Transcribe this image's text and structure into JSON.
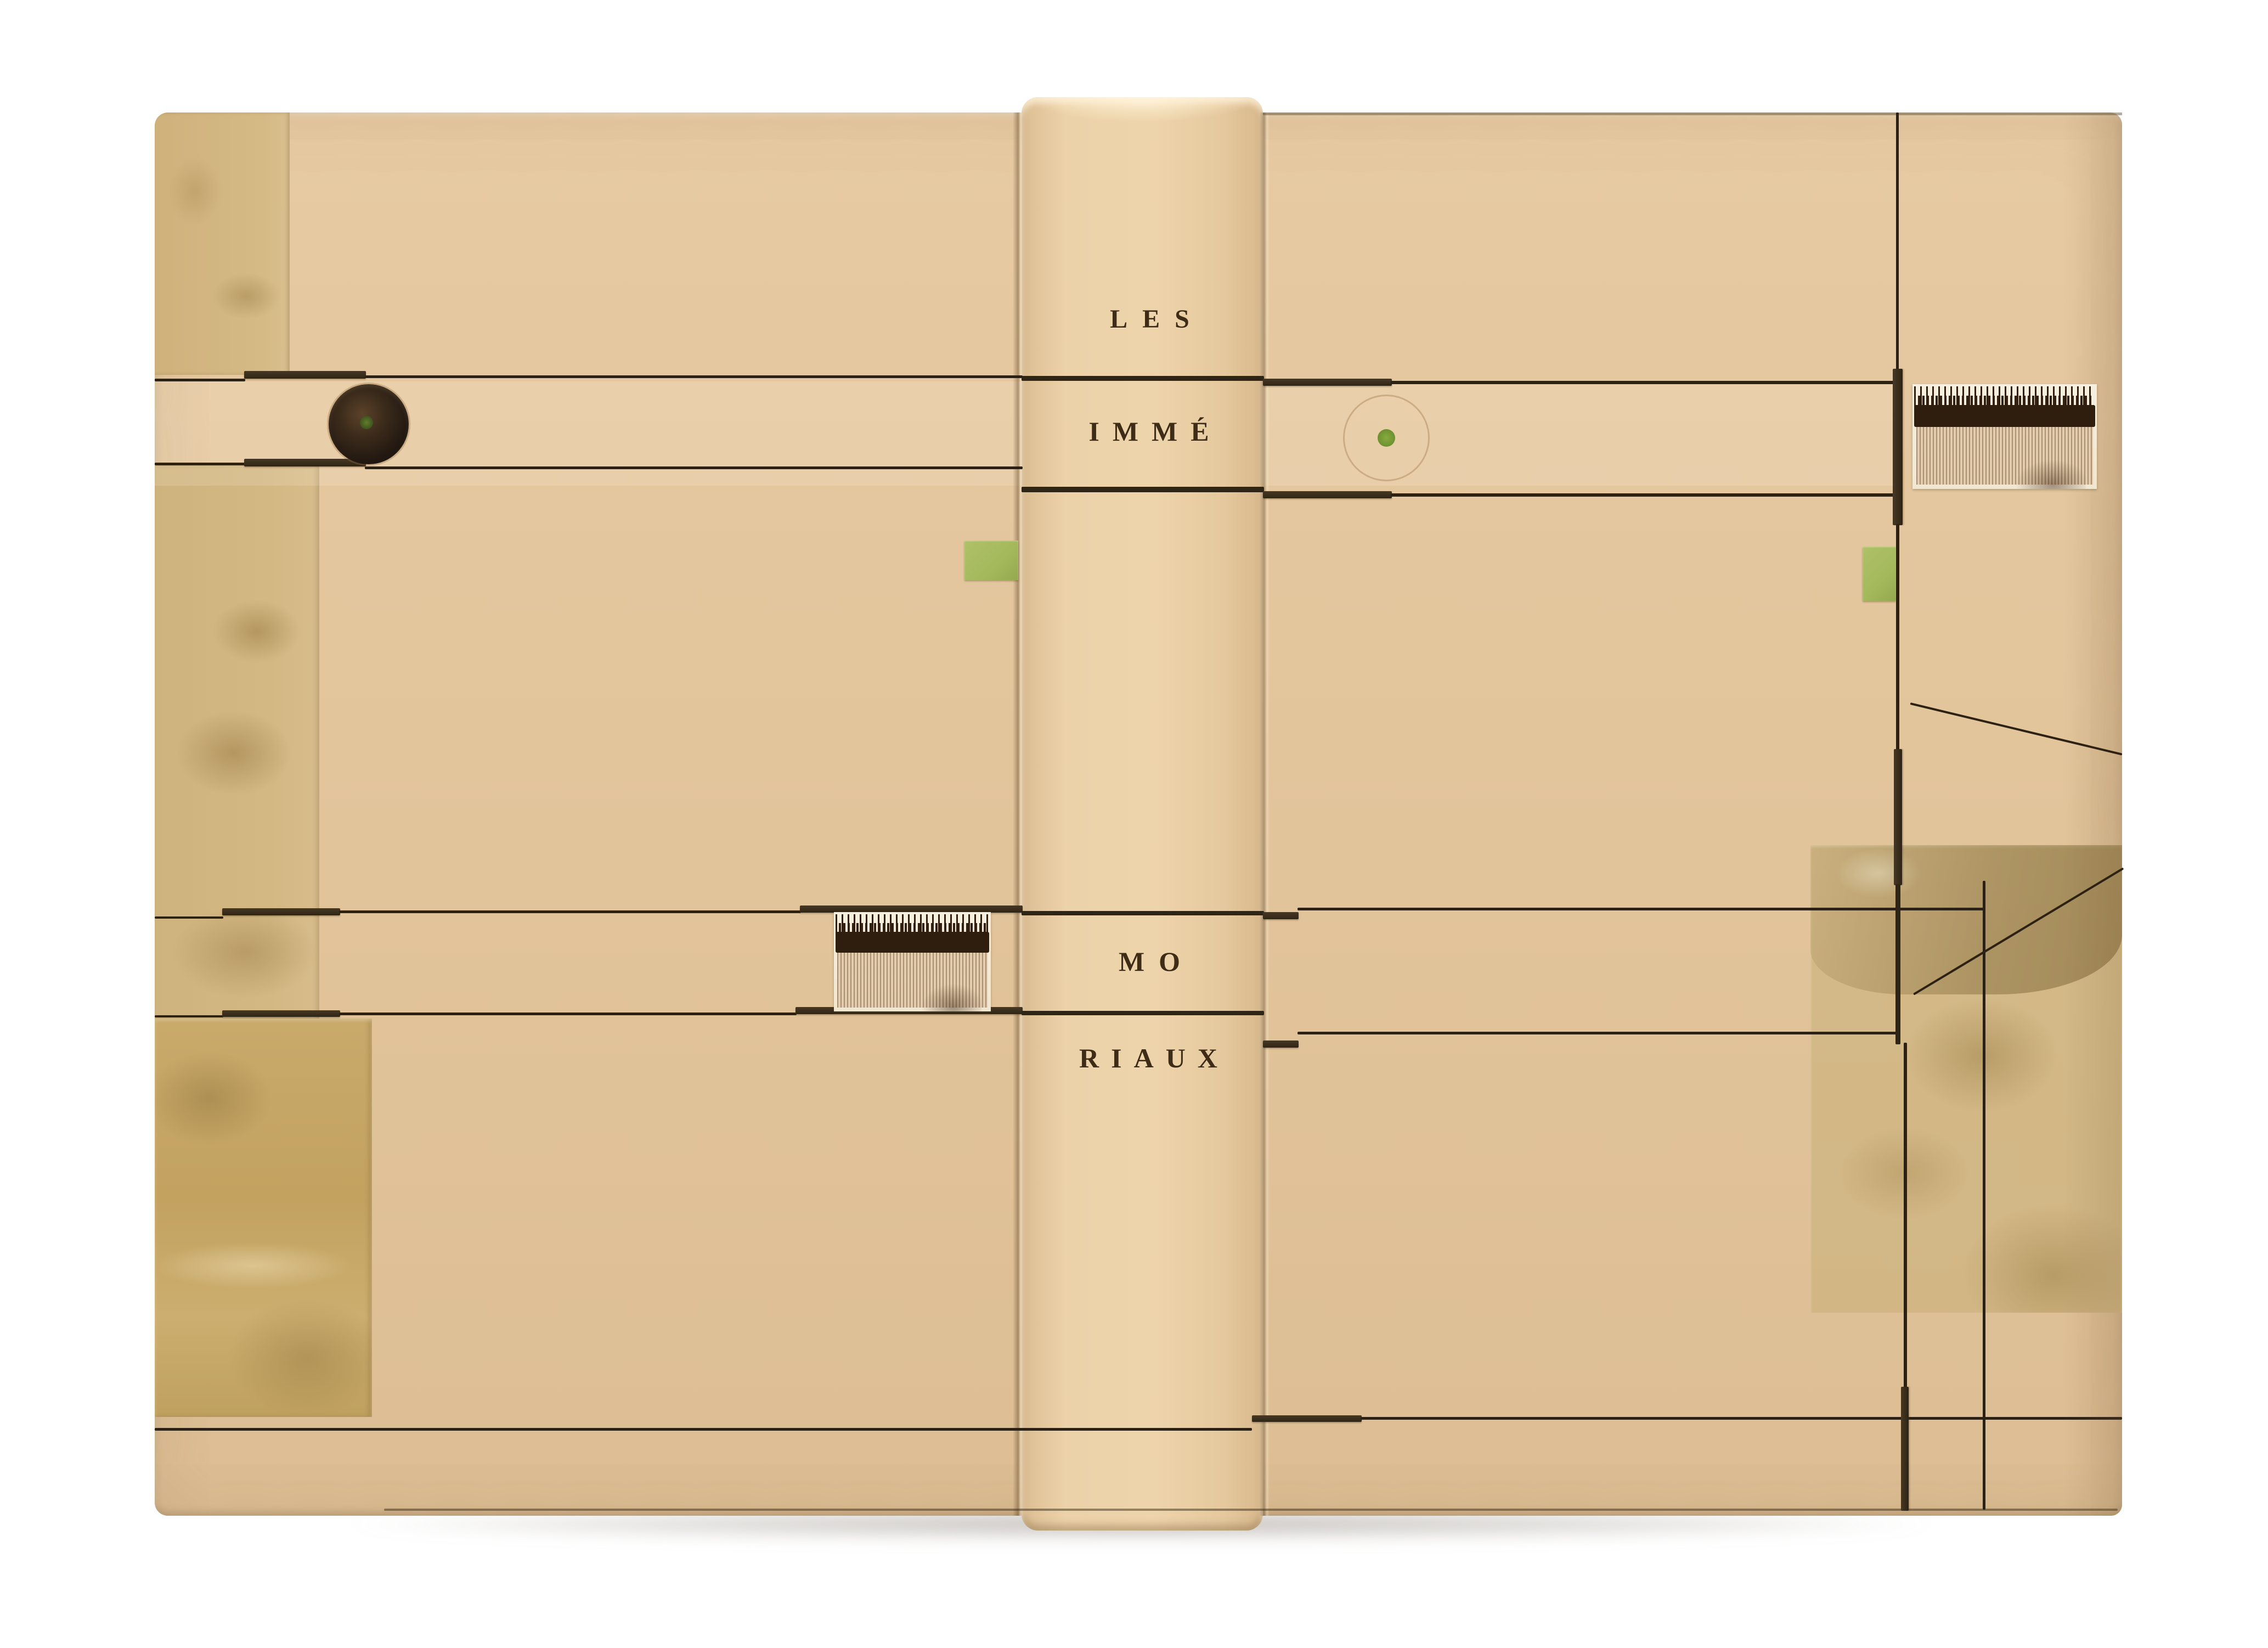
{
  "object": {
    "kind": "photograph of a fine leather book binding, covers and spine laid flat on white",
    "spine": {
      "title_lines": [
        "LES",
        "IMMÉ",
        "MO",
        "RIAUX"
      ],
      "title_full": "LES IMMÉMORIAUX"
    },
    "palette": {
      "background": "#ffffff",
      "leather": "#e4c69e",
      "leather_spine": "#ecd2a9",
      "olive_paper": "#c9ab72",
      "marbled_paper": "#d2b785",
      "line_dark": "#2c2113",
      "onlay_strip": "#3c2f1d",
      "accent_green": "#a4b85c",
      "circle_dark": "#261b10",
      "dot_green": "#7ba23a",
      "fringe_paper": "#f3ebd8",
      "title_text": "#3e2c17"
    }
  }
}
